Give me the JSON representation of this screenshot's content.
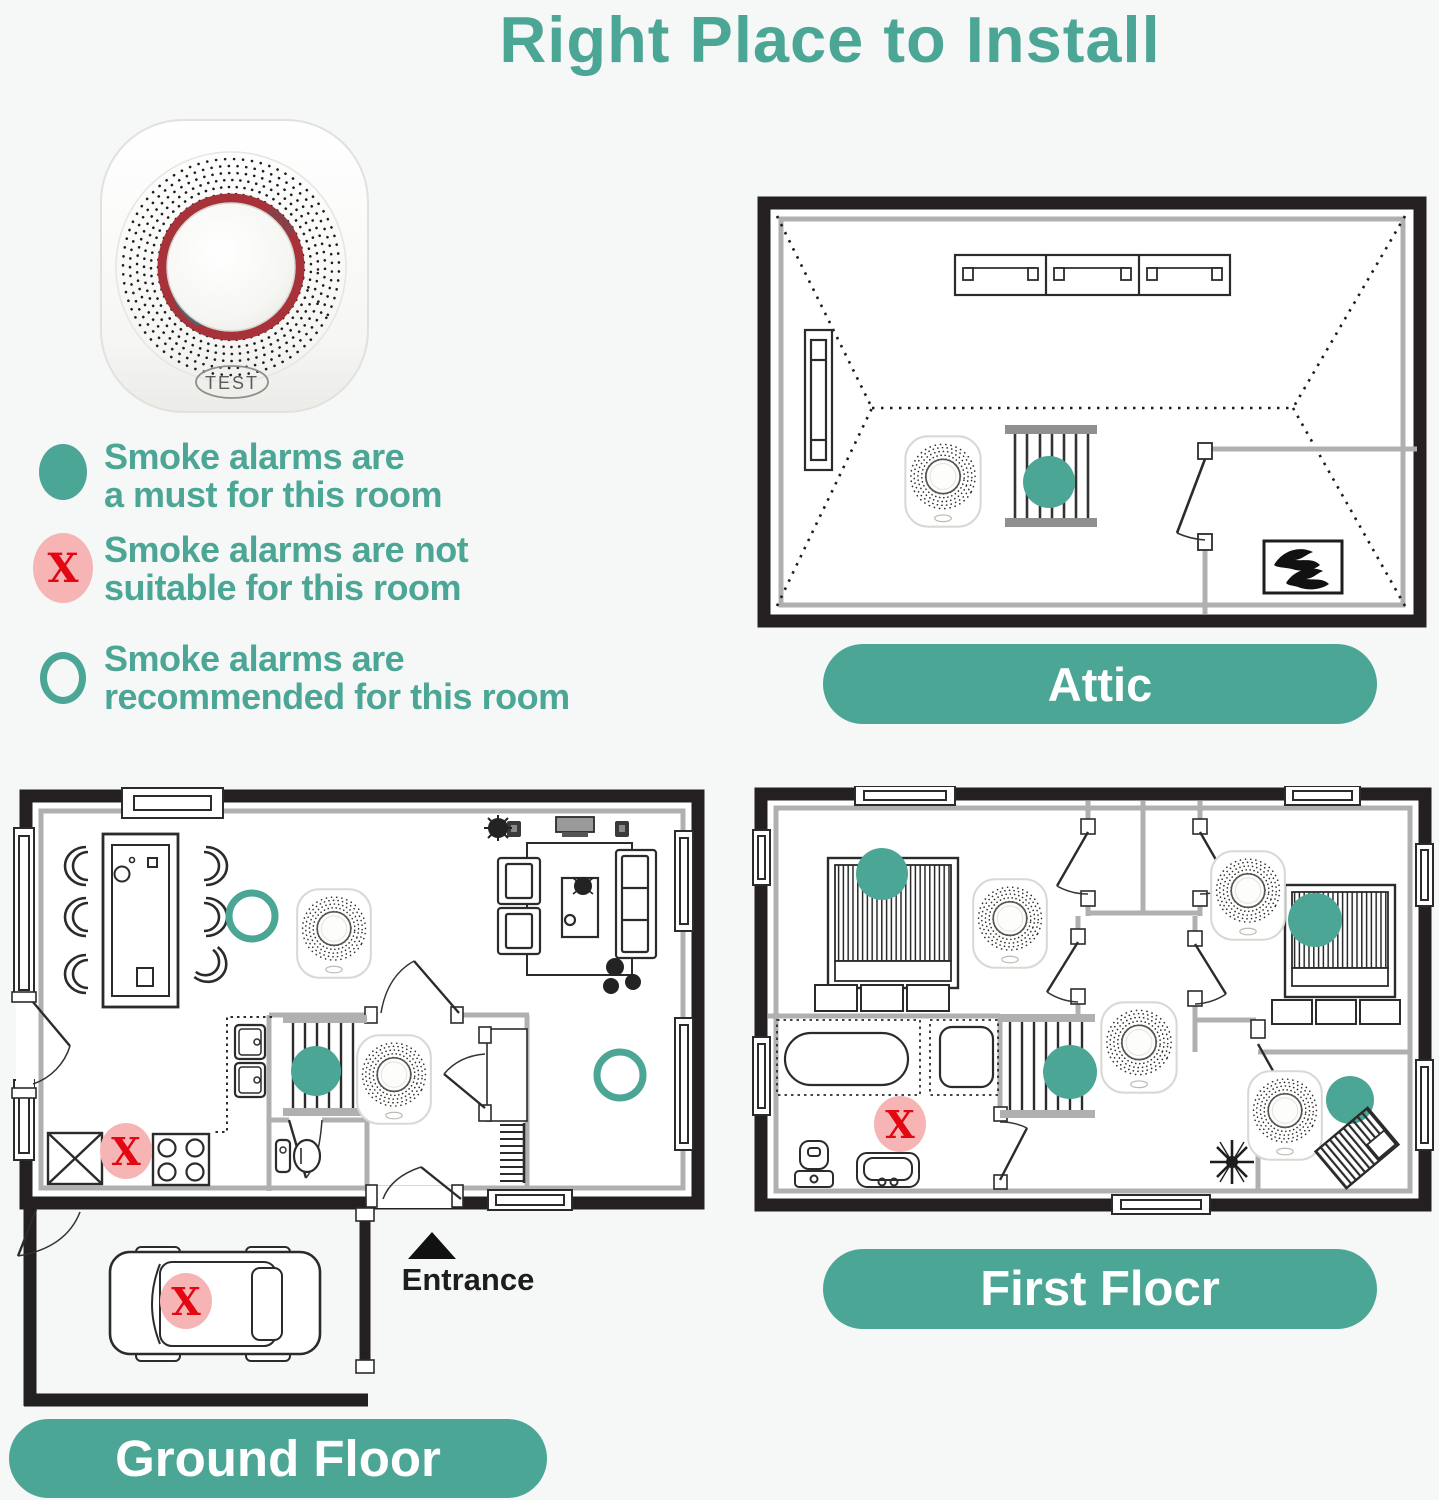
{
  "title": "Right Place to Install",
  "device": {
    "test_label": "TEST"
  },
  "legend": {
    "items": [
      {
        "marker": "teal-filled-circle",
        "line1": "Smoke alarms are",
        "line2": "a must for this room"
      },
      {
        "marker": "pink-x-circle",
        "line1": "Smoke alarms are not",
        "line2": "suitable for this room"
      },
      {
        "marker": "teal-open-circle",
        "line1": "Smoke alarms are",
        "line2": "recommended for this room"
      }
    ]
  },
  "markers": {
    "x_glyph": "X"
  },
  "plans": {
    "attic": {
      "label": "Attic"
    },
    "ground_floor": {
      "label": "Ground Floor",
      "entrance_label": "Entrance"
    },
    "first_floor": {
      "label": "First Flocr"
    }
  },
  "colors": {
    "teal": "#4CA695",
    "pink": "#F6B5B4",
    "red": "#E30613",
    "wall_black": "#241F20",
    "wall_gray": "#B0B0B0",
    "background": "#F6F7F7"
  }
}
